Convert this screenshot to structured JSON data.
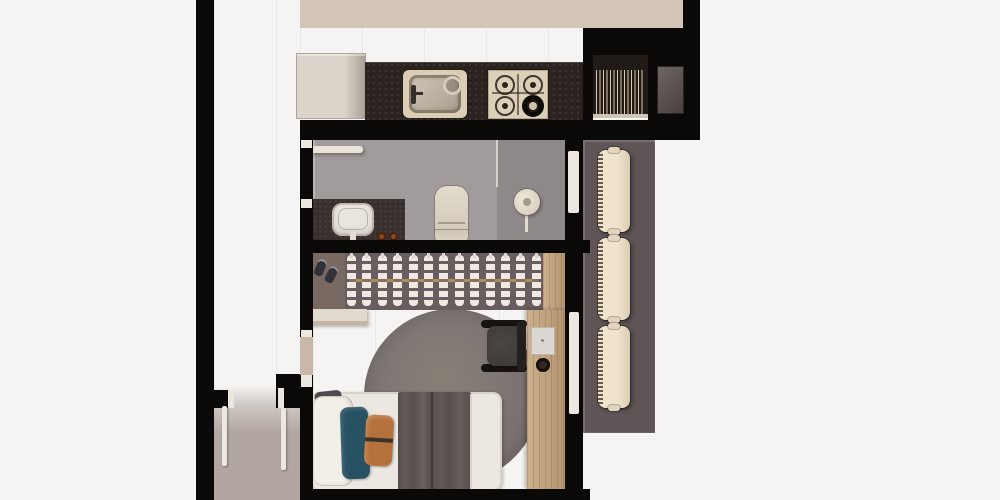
{
  "scene": {
    "view": "top-down 3d architectural render",
    "rooms": [
      "kitchen",
      "bathroom",
      "bedroom",
      "entry-hall",
      "service-corridor"
    ],
    "furniture": [
      "fridge-cabinet",
      "kitchen-counter",
      "sink",
      "gas-cooktop",
      "vent-grille",
      "towel-rail",
      "vanity-basin",
      "toilet",
      "shower-head",
      "wardrobe-with-hangers",
      "shoe-shelf",
      "bench",
      "round-rug",
      "single-bed",
      "desk",
      "office-chair",
      "radiators"
    ]
  },
  "colors": {
    "background": "#f5f4f2",
    "wall": "#0b0908",
    "kitchen_floor": "#cbbcae",
    "left_floor": "#c6b6a9",
    "entry_floor": "#b1a7a0",
    "bathroom_floor": "#a29b9c",
    "shower_floor": "#8e8889",
    "bedroom_floor": "#c8b7aa",
    "hall_floor": "#5f5556",
    "counter": "#2a231f",
    "cabinet": "#d8d2c9",
    "appliance_panel": "#ddd0b8",
    "vent_dark": "#211b18",
    "vent_stripe": "#d9c9ad",
    "shaft": "#5b5453",
    "white_trim": "#ece7df",
    "vanity_dark": "#37302e",
    "ceramic": "#e9e4dd",
    "knob_bronze": "#8a4a1f",
    "glass": "#d5cfc9",
    "radiator": "#e8dcc6",
    "closet_interior": "#685d5f",
    "shoe_cell": "#786a63",
    "rail_brass": "#ab8e5d",
    "hanger": "#efe9e1",
    "wood": "#c2a077",
    "rug": "#7b7372",
    "mattress": "#ece7e0",
    "blanket": "#5c5552",
    "pillow_teal": "#275263",
    "pillow_orange": "#b6713a",
    "cushion_dark": "#4d494d",
    "chair": "#46403d",
    "chair_black": "#171310",
    "shoe_dark": "#32313a"
  },
  "counts": {
    "stove_burners": 4,
    "closet_hangers": 13,
    "hall_radiators": 3
  }
}
